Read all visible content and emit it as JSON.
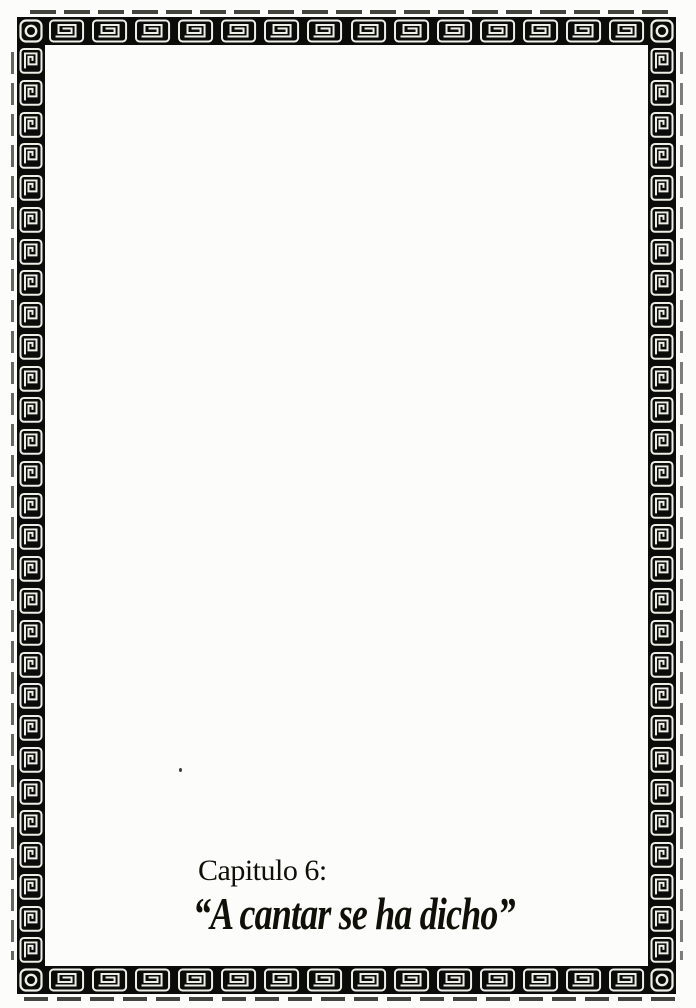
{
  "page": {
    "background_color": "#fcfcfa",
    "ink_color": "#111008",
    "chapter_label": "Capitulo 6:",
    "chapter_title": "“A cantar se ha dicho”"
  },
  "border": {
    "band_color": "#0b0b09",
    "glyph_color": "#eeeee6",
    "corner_icon": "circle-medallion-tile-icon",
    "edge_icon": "greek-key-spiral-tile-icon",
    "tiles": {
      "top": 14,
      "bottom": 14,
      "left": 29,
      "right": 29
    }
  }
}
